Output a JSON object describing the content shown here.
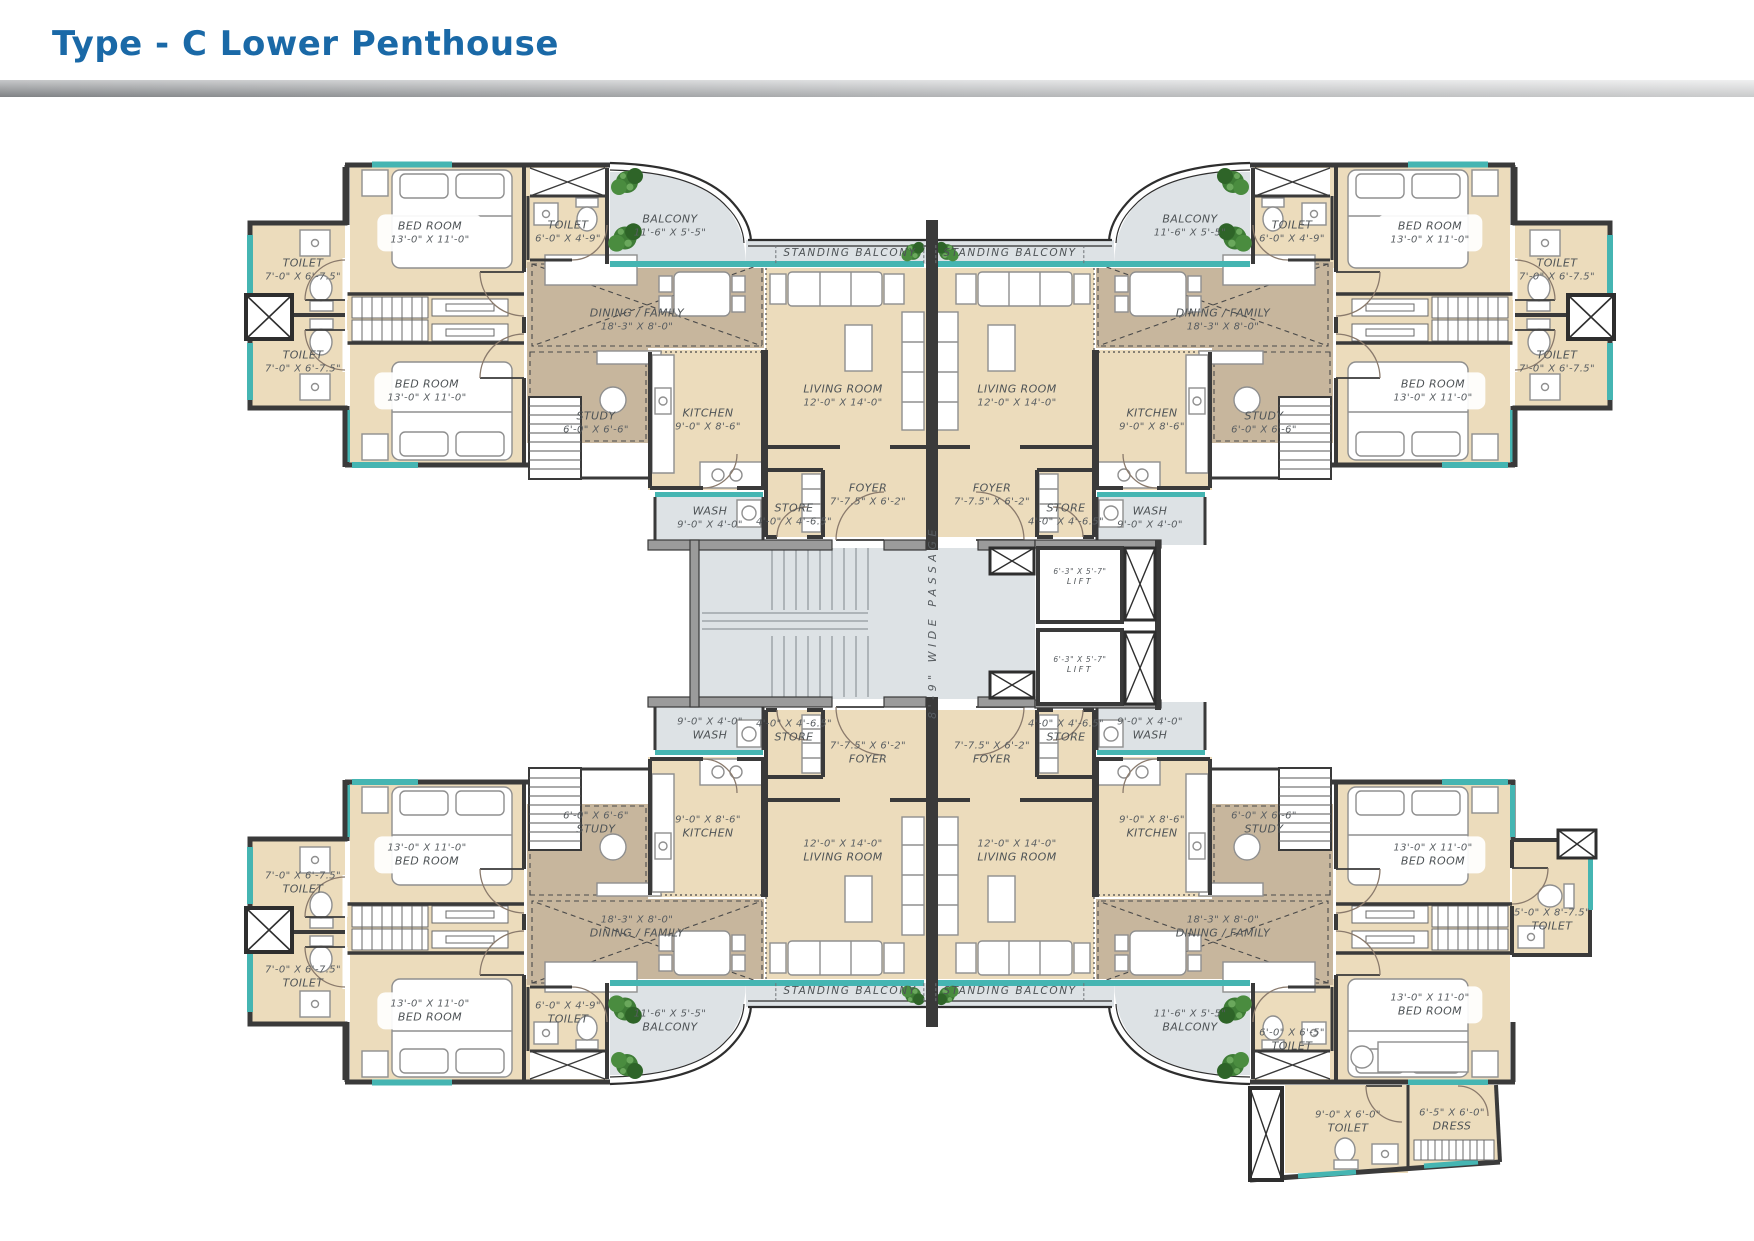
{
  "header": {
    "title": "Type - C  Lower Penthouse"
  },
  "rooms": {
    "bedroom": {
      "name": "BED ROOM",
      "dim": "13'-0\" X 11'-0\""
    },
    "toilet_a": {
      "name": "TOILET",
      "dim": "7'-0\" X 6'-7.5\""
    },
    "toilet_b": {
      "name": "TOILET",
      "dim": "6'-0\" X 4'-9\""
    },
    "toilet_c": {
      "name": "TOILET",
      "dim": "6'-0\" X 6'-5\""
    },
    "toilet_d": {
      "name": "TOILET",
      "dim": "5'-0\" X 8'-7.5\""
    },
    "toilet_e": {
      "name": "TOILET",
      "dim": "9'-0\" X 6'-0\""
    },
    "dress": {
      "name": "DRESS",
      "dim": "6'-5\" X 6'-0\""
    },
    "balcony": {
      "name": "BALCONY",
      "dim": "11'-6\" X 5'-5\""
    },
    "standing_balcony": {
      "name": "STANDING BALCONY"
    },
    "dining": {
      "name": "DINING / FAMILY",
      "dim": "18'-3\" X 8'-0\""
    },
    "study": {
      "name": "STUDY",
      "dim": "6'-0\" X 6'-6\""
    },
    "kitchen": {
      "name": "KITCHEN",
      "dim": "9'-0\" X 8'-6\""
    },
    "living": {
      "name": "LIVING ROOM",
      "dim": "12'-0\" X 14'-0\""
    },
    "foyer": {
      "name": "FOYER",
      "dim": "7'-7.5\" X 6'-2\""
    },
    "wash": {
      "name": "WASH",
      "dim": "9'-0\" X 4'-0\""
    },
    "store": {
      "name": "STORE",
      "dim": "4'-0\" X 4'-6.5\""
    },
    "lift": {
      "name": "LIFT",
      "dim": "6'-3\" X 5'-7\""
    }
  },
  "core": {
    "passage": "8'-9\" WIDE PASSAGE"
  },
  "colors": {
    "title_blue": "#1a69a7",
    "room_cream": "#ecdcbc",
    "family_tan": "#c7b69d",
    "floor_gray": "#dde2e5",
    "glass_teal": "#45b5b2",
    "wall_dark": "#3a3a3a",
    "plant_green": "#3e7c36"
  }
}
